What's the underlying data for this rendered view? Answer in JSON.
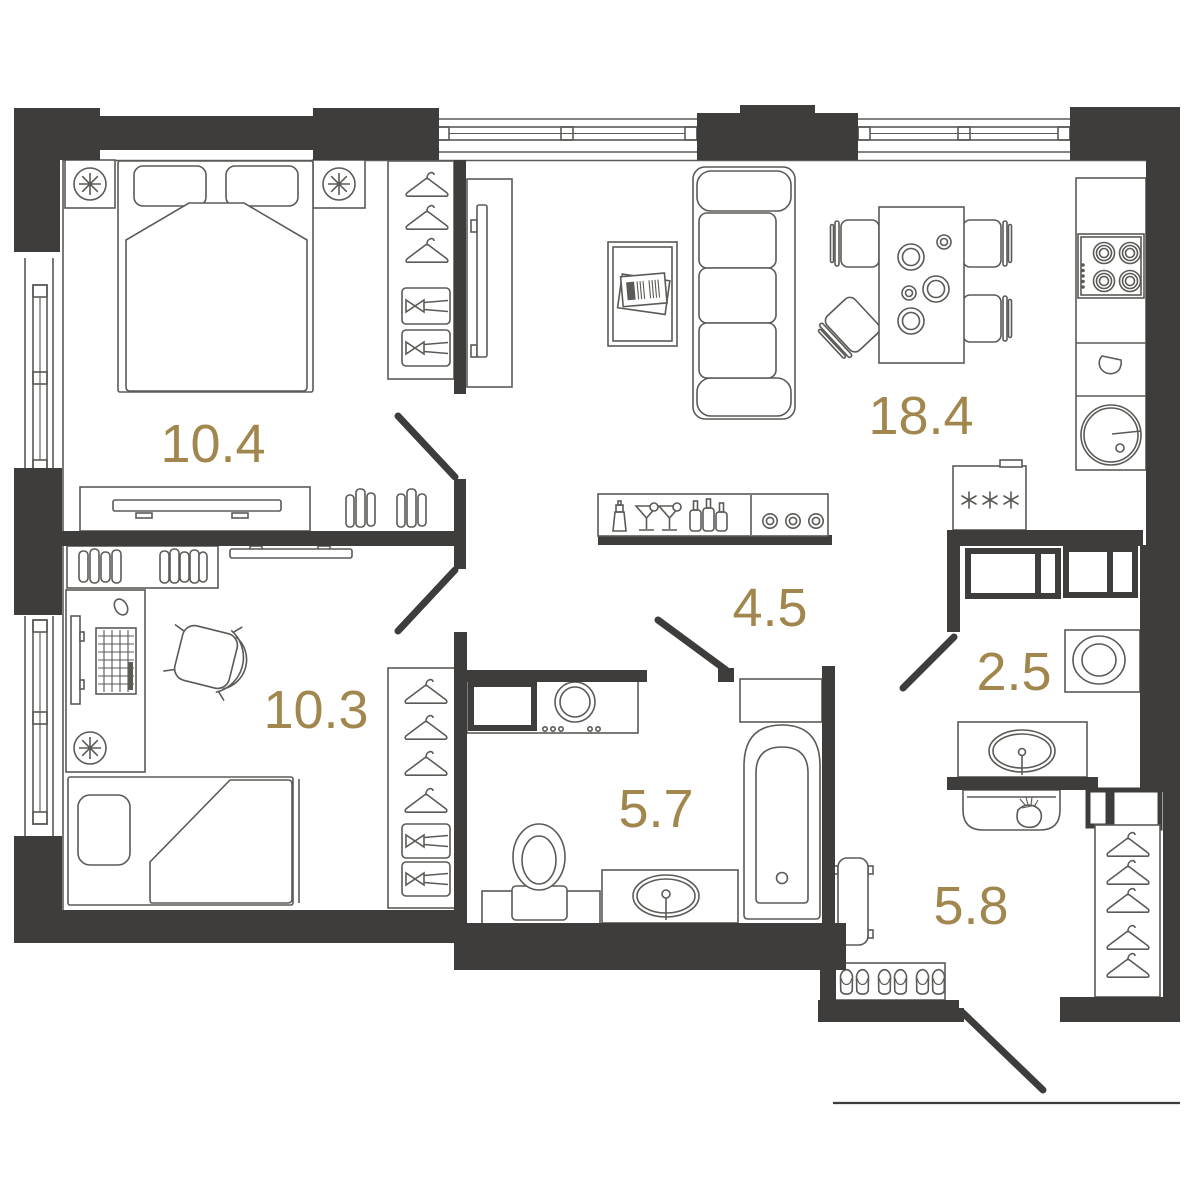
{
  "plan": {
    "type": "apartment-floor-plan",
    "rooms": [
      {
        "id": "bedroom-main",
        "area": "10.4"
      },
      {
        "id": "living-kitchen",
        "area": "18.4"
      },
      {
        "id": "bedroom-second",
        "area": "10.3"
      },
      {
        "id": "hallway",
        "area": "4.5"
      },
      {
        "id": "bathroom",
        "area": "5.7"
      },
      {
        "id": "wc",
        "area": "2.5"
      },
      {
        "id": "entrance-hall",
        "area": "5.8"
      }
    ],
    "colors": {
      "wall": "#3e3d3b",
      "line": "#5b5a56",
      "label": "#a1874d",
      "background": "#ffffff"
    },
    "icons": [
      "double-bed",
      "pillow",
      "blanket",
      "bedside-table",
      "bedside-lamp",
      "wardrobe-hanger",
      "drawer-knob",
      "tv-screen",
      "tv-dresser",
      "books",
      "wall-tv",
      "single-bed",
      "desk",
      "monitor",
      "keyboard",
      "mouse",
      "desk-chair",
      "radiator-fan",
      "sofa",
      "coffee-table",
      "magazine",
      "dining-table",
      "dining-chair",
      "plate",
      "cup",
      "cooktop-burner",
      "control-knobs",
      "kitchen-faucet",
      "kitchen-sink",
      "fridge-snowflakes",
      "bar-shaker",
      "martini-glass",
      "bottle",
      "coasters",
      "washing-machine",
      "toilet",
      "sink-vanity",
      "bathtub",
      "wall-cabinet",
      "top-load-washer",
      "bench",
      "slippers",
      "console-bag",
      "door-swing",
      "window"
    ]
  }
}
